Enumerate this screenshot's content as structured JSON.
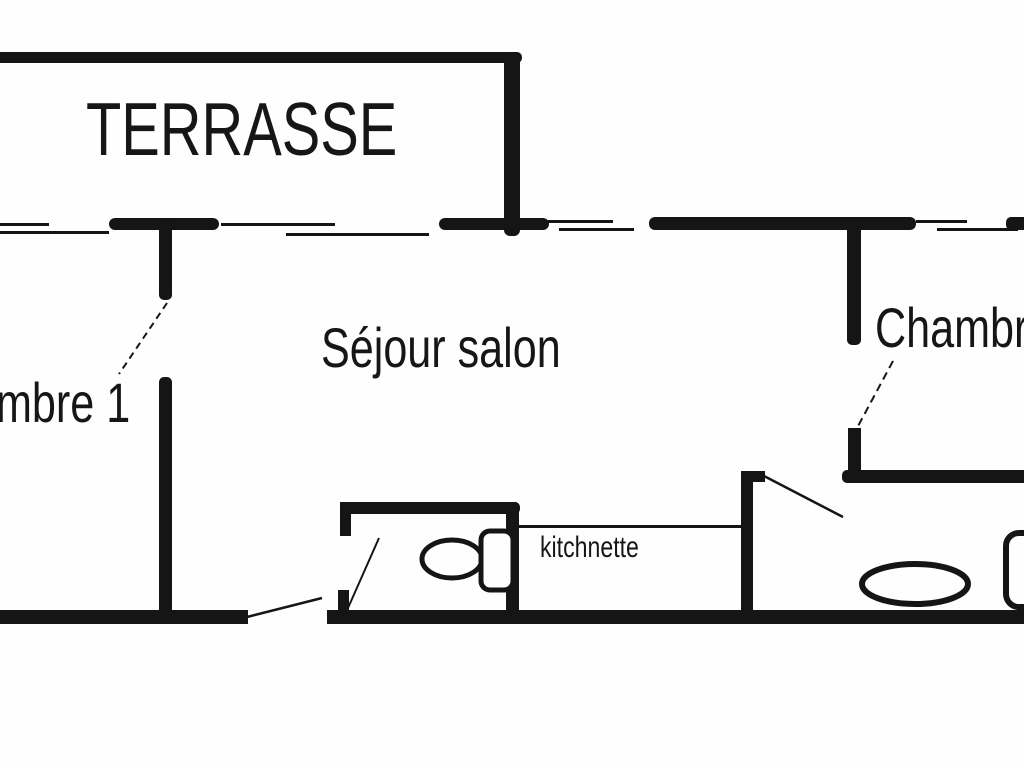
{
  "page": {
    "background_color": "#fefefe",
    "ink_color": "#151515",
    "description": "Apartment floor plan drawing"
  },
  "floor_plan": {
    "rooms": {
      "terrasse": {
        "label": "TERRASSE"
      },
      "sejour": {
        "label": "Séjour salon"
      },
      "chambre1": {
        "label": "mbre 1"
      },
      "chambre2": {
        "label": "Chambr"
      },
      "kitchnette": {
        "label": "kitchnette"
      }
    },
    "fixtures": [
      {
        "id": "toilet",
        "icon": "toilet-icon"
      },
      {
        "id": "bathtub",
        "icon": "bathtub-icon"
      },
      {
        "id": "washbasin",
        "icon": "washbasin-icon"
      }
    ]
  }
}
